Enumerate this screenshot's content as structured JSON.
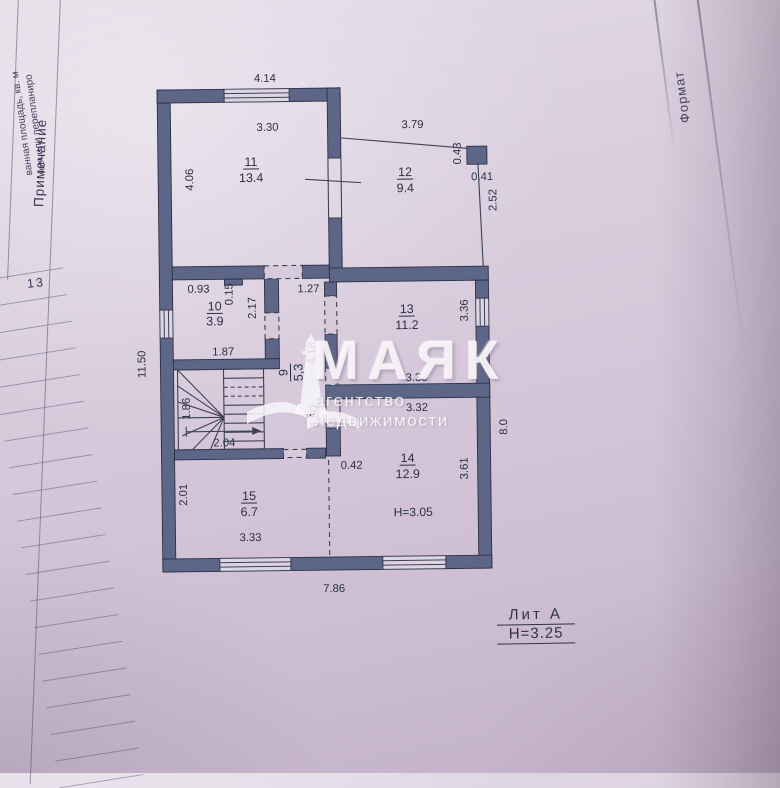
{
  "watermark": {
    "title": "МАЯК",
    "subtitle": "агентство недвижимости"
  },
  "side_table": {
    "caption_line1": "ния или перепланиро",
    "caption_line2": "ванная площадь, кв. м",
    "note_header": "Примечание",
    "row_number": "13"
  },
  "frame": {
    "format_label": "Формат"
  },
  "plan": {
    "litera": {
      "name": "Лит А",
      "height": "Н=3.25"
    },
    "rooms": {
      "r11": {
        "num": "11",
        "area": "13.4"
      },
      "r12": {
        "num": "12",
        "area": "9.4"
      },
      "r10": {
        "num": "10",
        "area": "3.9"
      },
      "r9": {
        "num": "9",
        "area": "5,3"
      },
      "r13": {
        "num": "13",
        "area": "11.2"
      },
      "r14": {
        "num": "14",
        "area": "12.9",
        "ceiling": "Н=3.05"
      },
      "r15": {
        "num": "15",
        "area": "6.7"
      }
    },
    "dims": {
      "top_outer": "4.14",
      "r11_top": "3.30",
      "r11_left": "4.06",
      "left_outer": "11.50",
      "porch_top": "3.79",
      "porch_col_h": "0.43",
      "porch_col_w": "0.41",
      "porch_right": "2.52",
      "r10_top": "0.93",
      "r10_step": "0.15",
      "r10_right": "2.17",
      "r10_bottom": "1.87",
      "hall_opening": "1.27",
      "hall_length": "4.18",
      "r13_right": "3.36",
      "r13_bottom": "3.33",
      "r14_top": "3.32",
      "r14_jamb": "1.50",
      "r14_stub": "0.42",
      "r14_right": "3.61",
      "right_outer": "8.0",
      "stairs_width": "1.86",
      "stairs_length": "2.04",
      "r15_left": "2.01",
      "r15_bottom": "3.33",
      "bottom_outer": "7.86"
    }
  }
}
